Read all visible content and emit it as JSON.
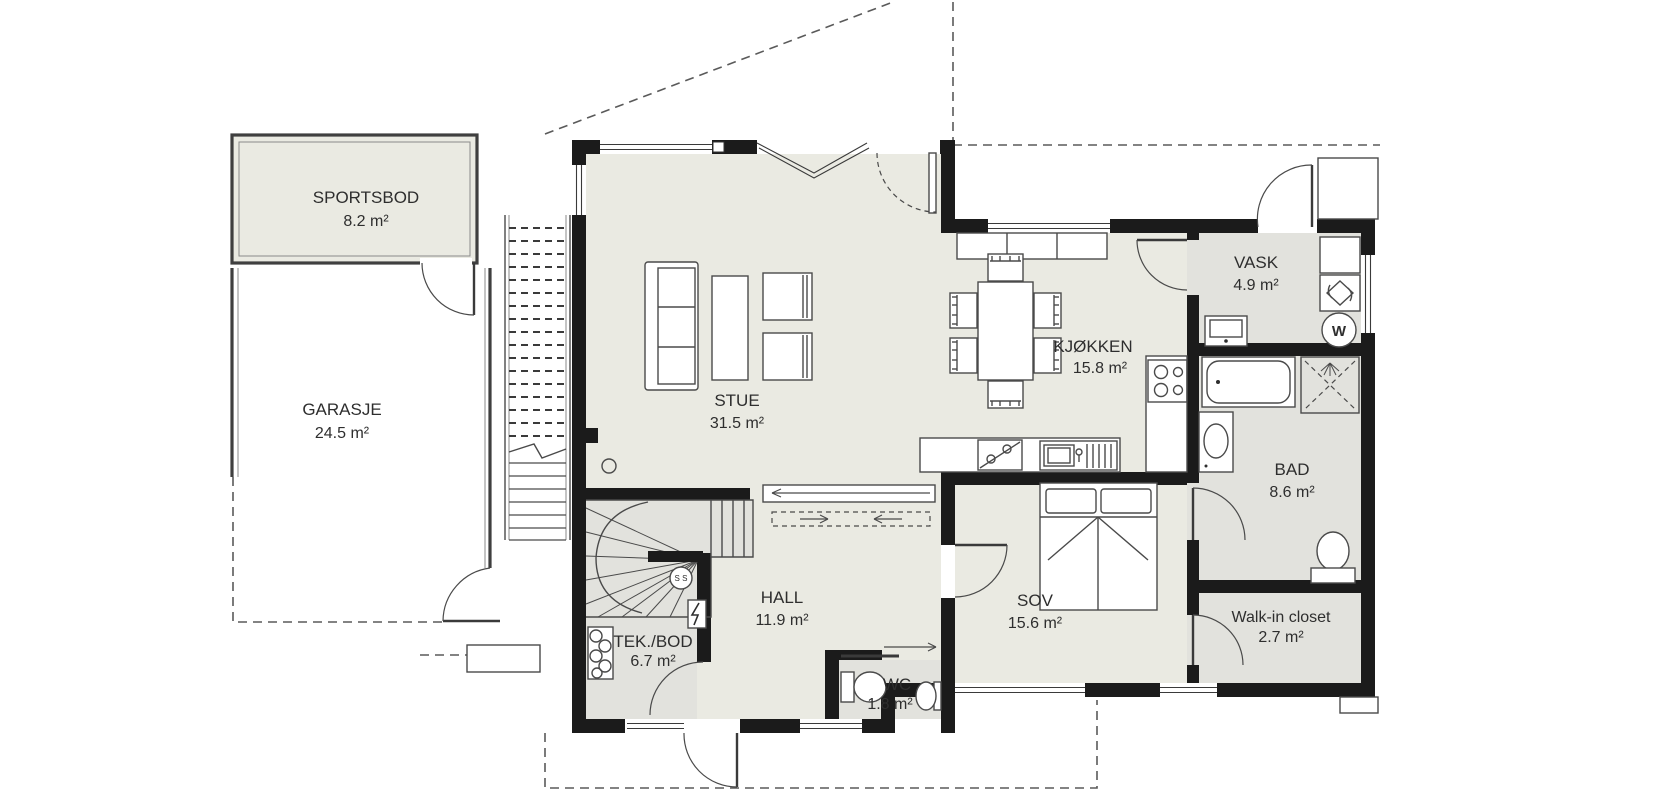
{
  "plan": {
    "type": "floor-plan",
    "rooms": [
      {
        "name": "SPORTSBOD",
        "area": "8.2 m²"
      },
      {
        "name": "GARASJE",
        "area": "24.5 m²"
      },
      {
        "name": "STUE",
        "area": "31.5 m²"
      },
      {
        "name": "KJØKKEN",
        "area": "15.8 m²"
      },
      {
        "name": "VASK",
        "area": "4.9 m²"
      },
      {
        "name": "BAD",
        "area": "8.6 m²"
      },
      {
        "name": "HALL",
        "area": "11.9 m²"
      },
      {
        "name": "TEK./BOD",
        "area": "6.7 m²"
      },
      {
        "name": "WC",
        "area": "1.8 m²"
      },
      {
        "name": "SOV",
        "area": "15.6 m²"
      },
      {
        "name": "Walk-in closet",
        "area": "2.7 m²"
      }
    ],
    "appliance_labels": {
      "washer": "W",
      "stair_mark": "S S"
    },
    "colors": {
      "wall": "#1b1b1b",
      "floor_main": "#eaeae2",
      "floor_wet": "#e2e2dd",
      "line": "#4a4a4a"
    }
  }
}
